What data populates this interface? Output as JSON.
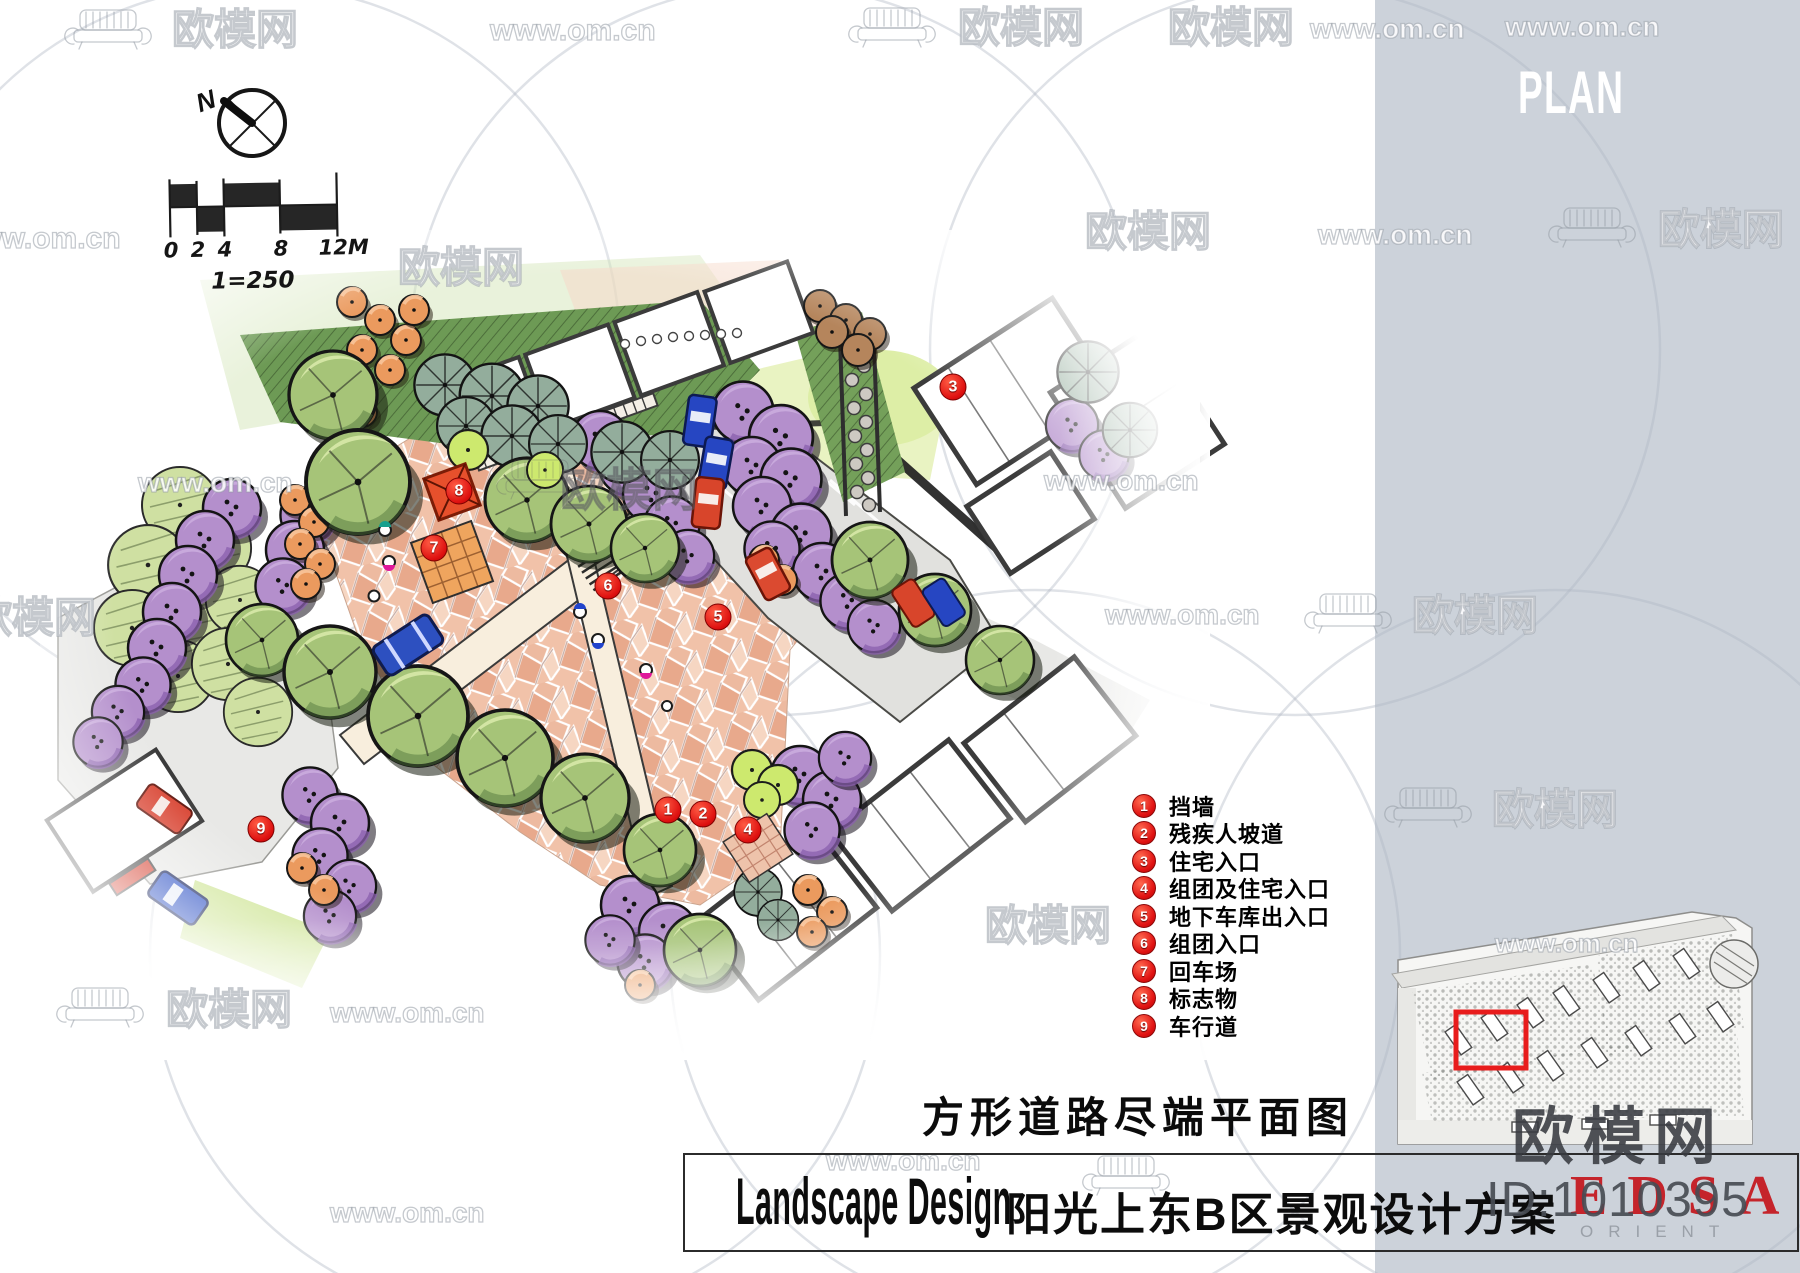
{
  "page": {
    "background": "#ffffff",
    "sidebar_color": "#ccd2da"
  },
  "sidebar": {
    "label": "PLAN"
  },
  "compass": {
    "north": "N"
  },
  "scale_bar": {
    "ticks": [
      "0",
      "2",
      "4",
      "8",
      "12M"
    ],
    "ratio": "1=250"
  },
  "plan": {
    "title": "方形道路尽端平面图",
    "markers": [
      "1",
      "2",
      "3",
      "4",
      "5",
      "6",
      "7",
      "8",
      "9"
    ]
  },
  "legend": {
    "items": [
      {
        "number": "1",
        "label": "挡墙"
      },
      {
        "number": "2",
        "label": "残疾人坡道"
      },
      {
        "number": "3",
        "label": "住宅入口"
      },
      {
        "number": "4",
        "label": "组团及住宅入口"
      },
      {
        "number": "5",
        "label": "地下车库出入口"
      },
      {
        "number": "6",
        "label": "组团入口"
      },
      {
        "number": "7",
        "label": "回车场"
      },
      {
        "number": "8",
        "label": "标志物"
      },
      {
        "number": "9",
        "label": "车行道"
      }
    ]
  },
  "footer": {
    "title_en": "Landscape Design",
    "title_zh": "阳光上东B区景观设计方案"
  },
  "logo": {
    "id_text": "ID:1010395",
    "brand": "EDSA",
    "brand_sub": "ORIENT",
    "brand_color": "#c5242b"
  },
  "watermark": {
    "name": "欧模网",
    "url": "www.om.cn"
  },
  "minimap": {
    "highlight_color": "#e81c1c"
  }
}
